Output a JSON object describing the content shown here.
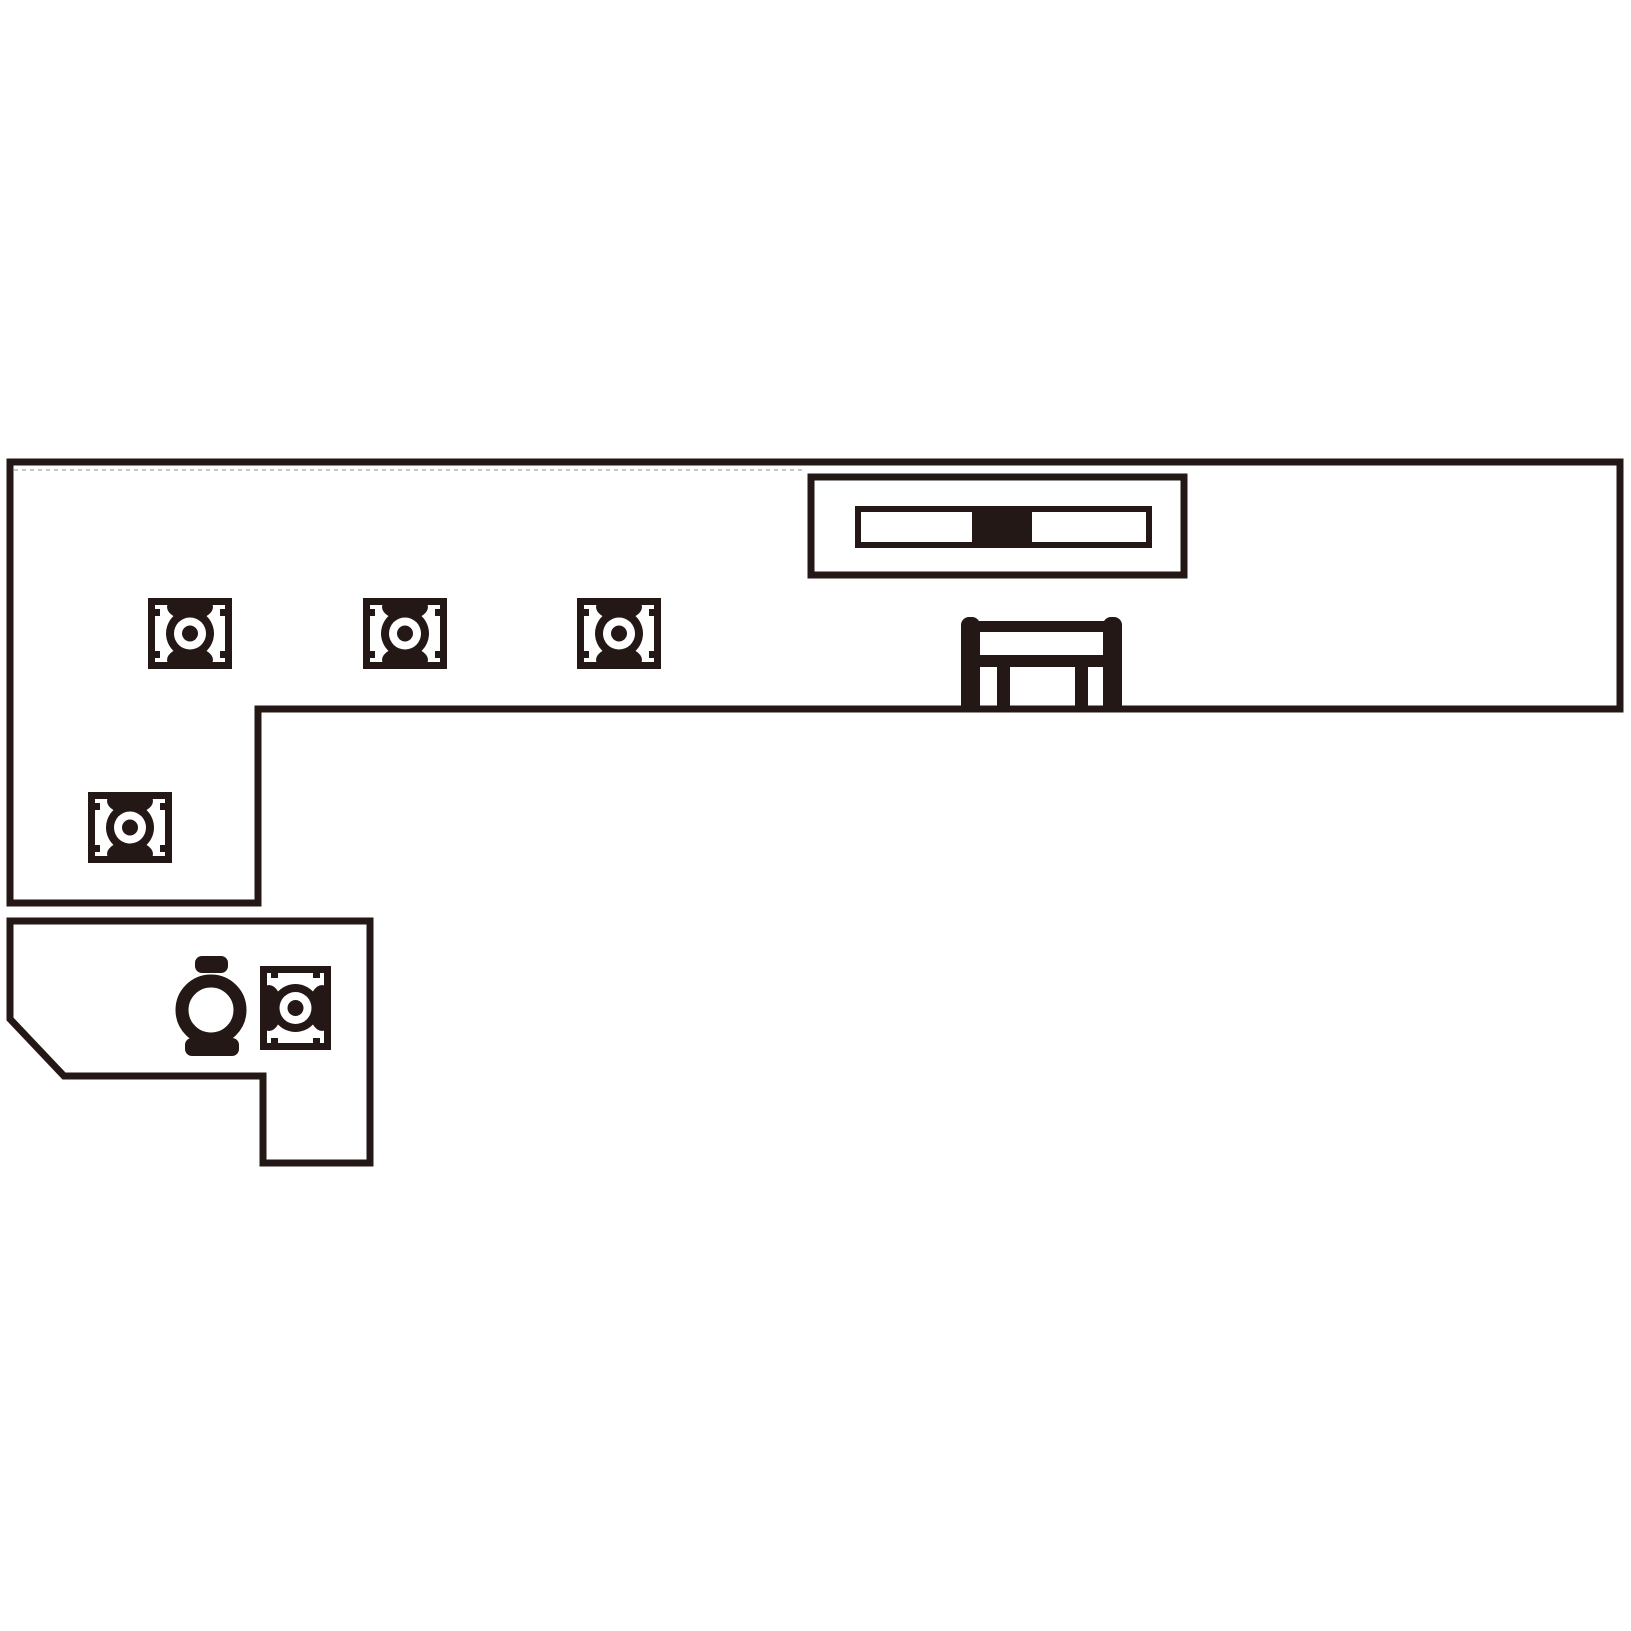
{
  "canvas": {
    "width": 1631,
    "height": 1631,
    "background_color": "#ffffff",
    "ink_color": "#231815",
    "hidden_line_color": "#c9c3c3"
  },
  "diagram": {
    "kind": "kitchen-counter-plan-line-drawing",
    "counter_outline": {
      "name": "l-shaped-counter-outline",
      "stroke_width": 7,
      "points": [
        [
          10,
          462
        ],
        [
          1620,
          462
        ],
        [
          1620,
          709
        ],
        [
          258,
          709
        ],
        [
          258,
          903
        ],
        [
          10,
          903
        ]
      ]
    },
    "desk_outline": {
      "name": "lower-desk-outline",
      "stroke_width": 7,
      "points": [
        [
          10,
          921
        ],
        [
          370,
          921
        ],
        [
          370,
          1163
        ],
        [
          263,
          1163
        ],
        [
          263,
          1076
        ],
        [
          64,
          1076
        ],
        [
          10,
          1019
        ]
      ]
    },
    "hidden_edge": {
      "name": "counter-hidden-edge-dashed",
      "x1": 14,
      "y1": 470,
      "x2": 806,
      "y2": 470,
      "stroke_width": 2,
      "dash": "4 4"
    },
    "burners": [
      {
        "id": "burner-1",
        "x": 148,
        "y": 598,
        "w": 84,
        "h": 71,
        "rotated": false
      },
      {
        "id": "burner-2",
        "x": 363,
        "y": 598,
        "w": 84,
        "h": 71,
        "rotated": false
      },
      {
        "id": "burner-3",
        "x": 577,
        "y": 598,
        "w": 84,
        "h": 71,
        "rotated": false
      },
      {
        "id": "burner-4",
        "x": 88,
        "y": 792,
        "w": 84,
        "h": 71,
        "rotated": false
      },
      {
        "id": "burner-5",
        "x": 253.5,
        "y": 972.5,
        "w": 84,
        "h": 71,
        "rotated": true
      }
    ],
    "fixture": {
      "name": "hood-fixture",
      "outer": {
        "x": 811,
        "y": 477,
        "w": 373,
        "h": 98,
        "stroke_width": 7
      },
      "inner": {
        "x": 858,
        "y": 509,
        "w": 291,
        "h": 36,
        "stroke_width": 6
      },
      "block": {
        "x": 972,
        "y": 506,
        "w": 60,
        "h": 42
      }
    },
    "bench": {
      "name": "bench-symbol",
      "left_post": {
        "x": 961,
        "y": 617,
        "w": 19,
        "h": 93,
        "r": 8
      },
      "right_post": {
        "x": 1103,
        "y": 617,
        "w": 19,
        "h": 93,
        "r": 8
      },
      "top_rail": {
        "x": 978,
        "y": 621,
        "w": 127,
        "h": 11
      },
      "mid_rail": {
        "x": 978,
        "y": 655,
        "w": 127,
        "h": 12
      },
      "left_leg": {
        "x": 997,
        "y": 665,
        "w": 13,
        "h": 44
      },
      "right_leg": {
        "x": 1075,
        "y": 665,
        "w": 13,
        "h": 44
      }
    },
    "kettle": {
      "name": "kettle-symbol",
      "lid": {
        "x": 195,
        "y": 956,
        "w": 33,
        "h": 17,
        "r": 7
      },
      "body": {
        "cx": 211,
        "cy": 1010,
        "r": 29,
        "stroke_width": 13
      },
      "base": {
        "x": 185,
        "y": 1038,
        "w": 54,
        "h": 18,
        "r": 7
      }
    }
  }
}
